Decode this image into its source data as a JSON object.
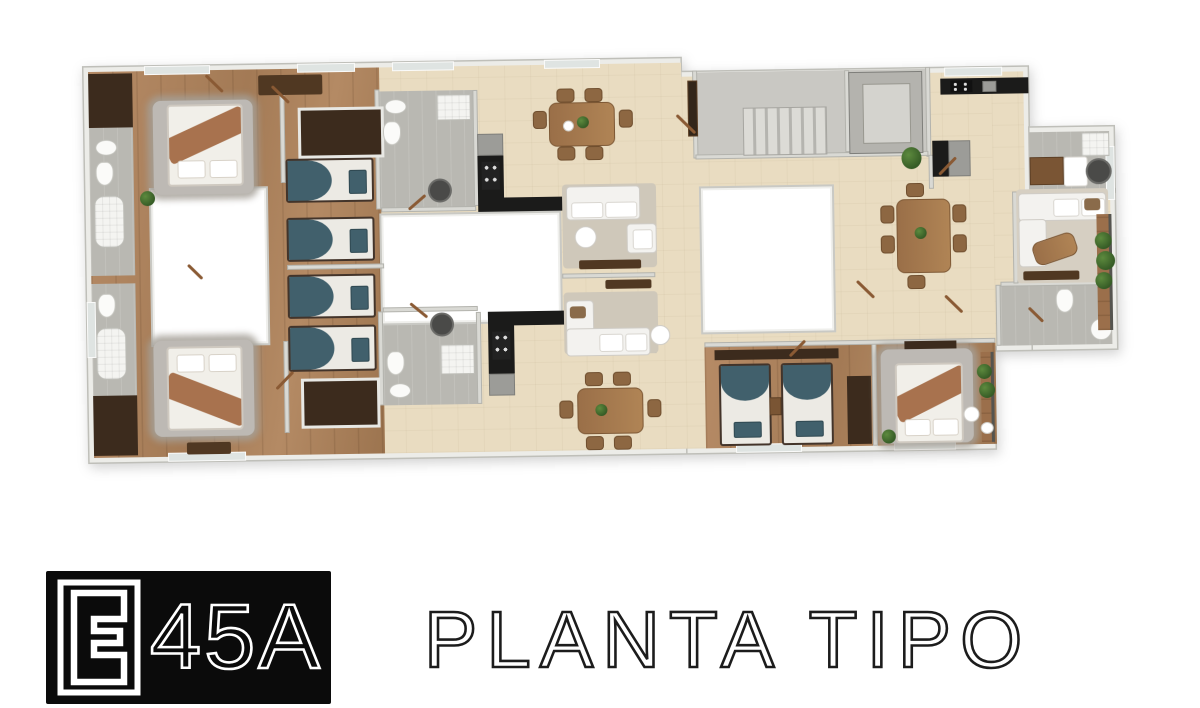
{
  "branding": {
    "logo_text": "45A",
    "logo_mark": "E-monogram-icon",
    "title": "PLANTA TIPO"
  },
  "plan": {
    "kind": "residential-floor-plan-3d-render",
    "patio_lightwells": 3,
    "features": [
      "bedrooms",
      "bathrooms",
      "kitchens",
      "dining-areas",
      "living-rooms",
      "staircase",
      "elevator",
      "balconies",
      "laundry",
      "closets"
    ]
  },
  "colors": {
    "paper": "#ffffff",
    "logo": "#0b0b0b",
    "ink": "#1c1c1c",
    "beige": "#e9dcc1",
    "wood": "#b08663",
    "tile": "#b9b8b2",
    "counter": "#1b1b1a",
    "teal": "#41606c",
    "blanket": "#a8724e",
    "closet": "#3c2b1d",
    "plant": "#365c26"
  }
}
